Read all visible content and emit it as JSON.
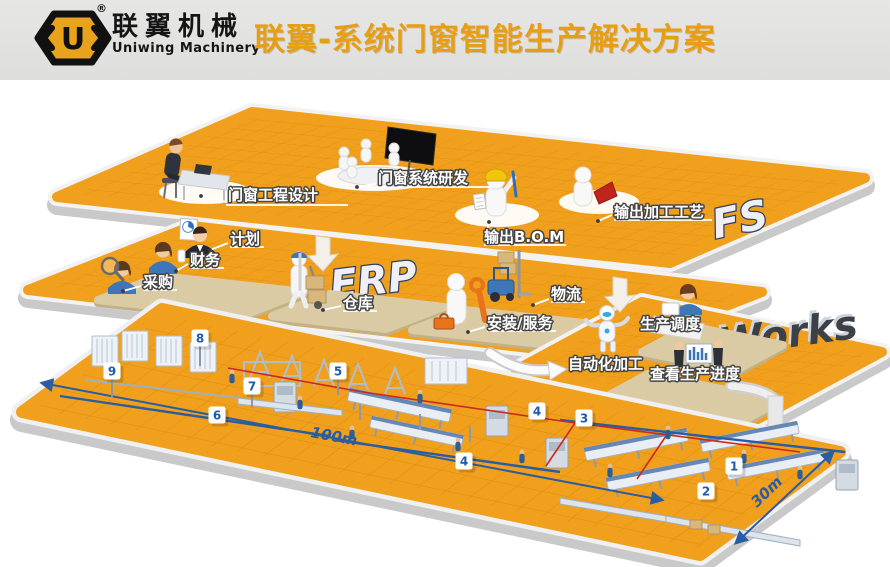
{
  "header": {
    "brand_cn": "联翼机械",
    "brand_en": "Uniwing Machinery",
    "registered_mark": "®",
    "logo_letter": "U",
    "title": "联翼-系统门窗智能生产解决方案"
  },
  "diagram": {
    "colors": {
      "platform_orange": "#F1A01D",
      "grid_line": "#DD8E10",
      "title_orange": "#E79E15",
      "marker_blue": "#1B5CAB",
      "dimension_blue": "#2A5CA0",
      "route_red": "#CC2A1E"
    },
    "layers": {
      "fs": {
        "watermark": "FS",
        "stations": {
          "design": "门窗工程设计",
          "rnd": "门窗系统研发",
          "bom": "输出B.O.M",
          "process": "输出加工工艺"
        }
      },
      "erp": {
        "watermark": "ERP",
        "stations": {
          "plan": "计划",
          "finance": "财务",
          "purchase": "采购",
          "warehouse": "仓库",
          "logistics": "物流",
          "service": "安装/服务"
        }
      },
      "eworks": {
        "watermark": "eWorks",
        "stations": {
          "dispatch": "生产调度",
          "auto": "自动化加工",
          "progress": "查看生产进度"
        }
      },
      "factory": {
        "dimensions": {
          "length": "100m",
          "width": "30m"
        },
        "markers": {
          "m1": "1",
          "m2": "2",
          "m3": "3",
          "m4a": "4",
          "m4b": "4",
          "m5": "5",
          "m6": "6",
          "m7": "7",
          "m8": "8",
          "m9": "9"
        }
      }
    }
  }
}
